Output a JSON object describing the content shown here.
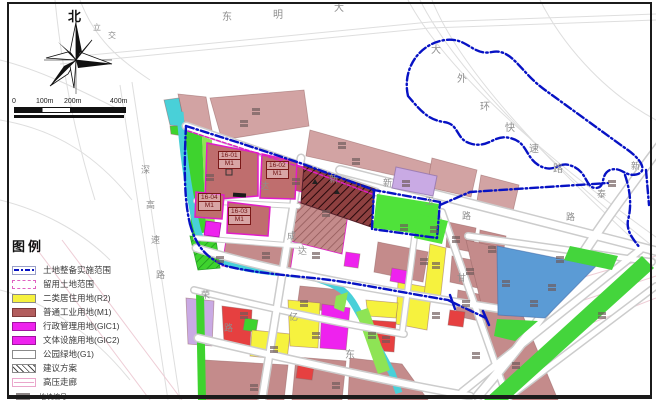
{
  "compass": {
    "north": "北"
  },
  "scalebar": {
    "labels": [
      "0",
      "100m",
      "200m",
      "400m"
    ]
  },
  "legend": {
    "title": "图例",
    "items": [
      {
        "label": "土地整备实施范围",
        "swatch": "boundary"
      },
      {
        "label": "留用土地范围",
        "swatch": "retained"
      },
      {
        "label": "二类居住用地(R2)",
        "swatch": "r2"
      },
      {
        "label": "普通工业用地(M1)",
        "swatch": "m1"
      },
      {
        "label": "行政管理用地(GIC1)",
        "swatch": "gic1"
      },
      {
        "label": "文体设施用地(GIC2)",
        "swatch": "gic2"
      },
      {
        "label": "公园绿地(G1)",
        "swatch": "g1"
      },
      {
        "label": "建议方案",
        "swatch": "hatch"
      },
      {
        "label": "高压走廊",
        "swatch": "corridor"
      }
    ],
    "code_item": {
      "top": "地块编号",
      "bottom": "用地性质代码"
    }
  },
  "map": {
    "parcel_labels": [
      {
        "code": "16-01",
        "use": "M1",
        "x": 218,
        "y": 151
      },
      {
        "code": "16-02",
        "use": "M1",
        "x": 266,
        "y": 161
      },
      {
        "code": "16-04",
        "use": "M1",
        "x": 198,
        "y": 193
      },
      {
        "code": "16-03",
        "use": "M1",
        "x": 228,
        "y": 207
      }
    ],
    "road_labels": [
      {
        "t": "东",
        "x": 222,
        "y": 13,
        "s": 10
      },
      {
        "t": "明",
        "x": 273,
        "y": 11,
        "s": 10
      },
      {
        "t": "大",
        "x": 334,
        "y": 4,
        "s": 10
      },
      {
        "t": "大",
        "x": 431,
        "y": 46,
        "s": 10
      },
      {
        "t": "外",
        "x": 457,
        "y": 75,
        "s": 10
      },
      {
        "t": "环",
        "x": 480,
        "y": 103,
        "s": 10
      },
      {
        "t": "快",
        "x": 505,
        "y": 124,
        "s": 10
      },
      {
        "t": "速",
        "x": 529,
        "y": 145,
        "s": 10
      },
      {
        "t": "路",
        "x": 553,
        "y": 165,
        "s": 10
      },
      {
        "t": "新",
        "x": 631,
        "y": 162
      },
      {
        "t": "泰",
        "x": 597,
        "y": 190
      },
      {
        "t": "路",
        "x": 566,
        "y": 213
      },
      {
        "t": "深",
        "x": 141,
        "y": 166
      },
      {
        "t": "高",
        "x": 146,
        "y": 201
      },
      {
        "t": "速",
        "x": 151,
        "y": 236
      },
      {
        "t": "路",
        "x": 156,
        "y": 271
      },
      {
        "t": "新",
        "x": 383,
        "y": 179
      },
      {
        "t": "玉",
        "x": 425,
        "y": 197
      },
      {
        "t": "路",
        "x": 462,
        "y": 212
      },
      {
        "t": "达",
        "x": 260,
        "y": 182
      },
      {
        "t": "新",
        "x": 329,
        "y": 175
      },
      {
        "t": "成",
        "x": 287,
        "y": 232
      },
      {
        "t": "达",
        "x": 298,
        "y": 247
      },
      {
        "t": "荣",
        "x": 201,
        "y": 291
      },
      {
        "t": "路",
        "x": 224,
        "y": 324
      },
      {
        "t": "亿",
        "x": 289,
        "y": 313
      },
      {
        "t": "东",
        "x": 345,
        "y": 351,
        "s": 10
      },
      {
        "t": "甘",
        "x": 457,
        "y": 274
      },
      {
        "t": "立",
        "x": 93,
        "y": 24,
        "s": 8
      },
      {
        "t": "交",
        "x": 108,
        "y": 32,
        "s": 8
      }
    ],
    "parcel_marks": [
      [
        252,
        108
      ],
      [
        338,
        142
      ],
      [
        292,
        178
      ],
      [
        322,
        210
      ],
      [
        402,
        180
      ],
      [
        400,
        224
      ],
      [
        430,
        226
      ],
      [
        262,
        252
      ],
      [
        312,
        252
      ],
      [
        240,
        312
      ],
      [
        270,
        346
      ],
      [
        312,
        332
      ],
      [
        382,
        336
      ],
      [
        332,
        382
      ],
      [
        432,
        262
      ],
      [
        466,
        268
      ],
      [
        502,
        280
      ],
      [
        548,
        284
      ],
      [
        472,
        352
      ],
      [
        512,
        362
      ],
      [
        598,
        312
      ],
      [
        206,
        174
      ],
      [
        216,
        256
      ],
      [
        432,
        312
      ],
      [
        556,
        256
      ],
      [
        608,
        180
      ],
      [
        240,
        120
      ],
      [
        352,
        158
      ],
      [
        530,
        300
      ],
      [
        452,
        236
      ],
      [
        488,
        246
      ],
      [
        462,
        300
      ],
      [
        420,
        258
      ],
      [
        300,
        300
      ],
      [
        250,
        384
      ],
      [
        368,
        332
      ]
    ]
  },
  "colors": {
    "boundary_blue": "#0712c4",
    "retained_magenta": "#e01cc8",
    "residential_yellow": "#f6f23e",
    "industrial_red": "#b25d5d",
    "admin_magenta": "#ee22ee",
    "park_green": "#3ed32e",
    "water_cyan": "#49d0d8",
    "parcel_rose": "#c48b8b",
    "blue_parcel": "#5b9bd5"
  }
}
